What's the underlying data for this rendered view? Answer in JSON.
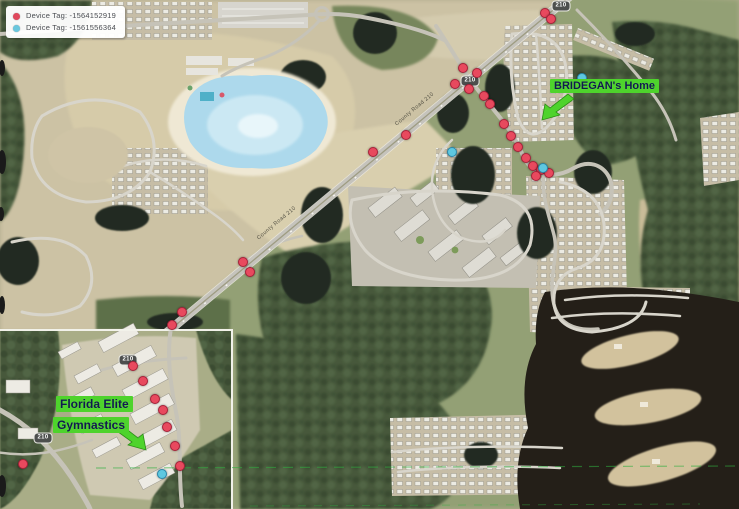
{
  "legend": {
    "items": [
      {
        "icon": "red-dot-icon",
        "color": "#e0485c",
        "label": "Device Tag: -1564152919"
      },
      {
        "icon": "blue-dot-icon",
        "color": "#6ac7dd",
        "label": "Device Tag: -1561556364"
      }
    ]
  },
  "annotations": {
    "highlight_color": "#4ed32c",
    "text_color": "#101a4d",
    "bridegan_home": {
      "text": "BRIDEGAN's Home"
    },
    "florida_elite": {
      "line1": "Florida Elite",
      "line2": "Gymnastics"
    }
  },
  "road_shields": [
    {
      "text": "210",
      "x": 561,
      "y": 6
    },
    {
      "text": "210",
      "x": 470,
      "y": 81
    },
    {
      "text": "210",
      "x": 128,
      "y": 360
    },
    {
      "text": "210",
      "x": 43,
      "y": 438
    }
  ],
  "road_labels": [
    {
      "text": "County Road 210",
      "x": 258,
      "y": 236,
      "angle": -40
    },
    {
      "text": "County Road 210",
      "x": 396,
      "y": 122,
      "angle": -40
    }
  ],
  "markers": {
    "red": [
      [
        545,
        13
      ],
      [
        551,
        19
      ],
      [
        463,
        68
      ],
      [
        477,
        73
      ],
      [
        455,
        84
      ],
      [
        469,
        89
      ],
      [
        484,
        96
      ],
      [
        490,
        104
      ],
      [
        504,
        124
      ],
      [
        511,
        136
      ],
      [
        518,
        147
      ],
      [
        526,
        158
      ],
      [
        533,
        166
      ],
      [
        541,
        170
      ],
      [
        549,
        173
      ],
      [
        536,
        176
      ],
      [
        406,
        135
      ],
      [
        373,
        152
      ],
      [
        243,
        262
      ],
      [
        250,
        272
      ],
      [
        182,
        312
      ],
      [
        172,
        325
      ],
      [
        133,
        366
      ],
      [
        143,
        381
      ],
      [
        155,
        399
      ],
      [
        163,
        410
      ],
      [
        167,
        427
      ],
      [
        175,
        446
      ],
      [
        180,
        466
      ],
      [
        23,
        464
      ]
    ],
    "blue": [
      [
        582,
        78
      ],
      [
        452,
        152
      ],
      [
        543,
        168
      ],
      [
        162,
        474
      ]
    ]
  }
}
